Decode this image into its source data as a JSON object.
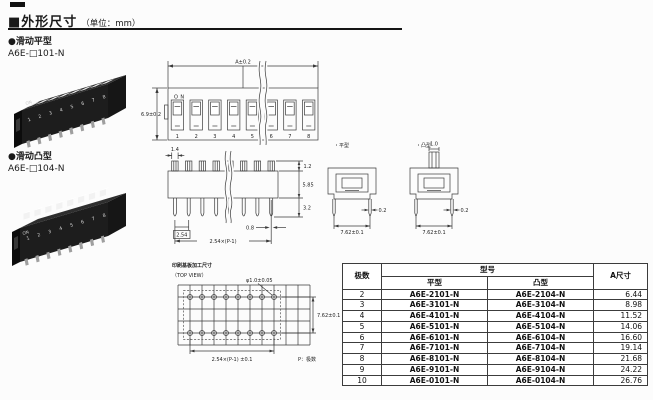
{
  "page": {
    "title": "■外形尺寸",
    "unit": "（单位：mm）"
  },
  "sections": {
    "flat": {
      "label": "●滑动平型",
      "model": "A6E-□101-N"
    },
    "convex": {
      "label": "●滑动凸型",
      "model": "A6E-□104-N"
    }
  },
  "switch_labels": {
    "on": "ON",
    "positions": [
      "1",
      "2",
      "3",
      "4",
      "5",
      "6",
      "7",
      "8"
    ]
  },
  "front_view": {
    "dim_width": "A±0.2",
    "dim_height": "6.9±0.2"
  },
  "side_elevation": {
    "dim_knob_width": "1.4",
    "dim_protrusion": "1.2",
    "dim_body_height": "5.85",
    "dim_pin_length": "3.2",
    "dim_pitch": "2.54",
    "dim_span": "2.54×(P-1)",
    "dim_pin_width": "0.8"
  },
  "side_views": {
    "flat_label": "・平型",
    "convex_label": "・凸型",
    "dim_knob_width": "1.0",
    "dim_pin_thickness": "0.2",
    "dim_row_pitch": "7.62±0.1"
  },
  "pcb": {
    "title": "印刷基板加工尺寸",
    "view_label": "（TOP VIEW）",
    "dim_hole": "φ1.0±0.05",
    "dim_row_pitch": "7.62±0.1",
    "dim_span": "2.54×(P-1) ±0.1",
    "note": "P：极数"
  },
  "table": {
    "header_poles": "极数",
    "header_model": "型号",
    "header_flat": "平型",
    "header_convex": "凸型",
    "header_dim": "A尺寸",
    "rows": [
      {
        "poles": "2",
        "flat": "A6E-2101-N",
        "convex": "A6E-2104-N",
        "a": "6.44"
      },
      {
        "poles": "3",
        "flat": "A6E-3101-N",
        "convex": "A6E-3104-N",
        "a": "8.98"
      },
      {
        "poles": "4",
        "flat": "A6E-4101-N",
        "convex": "A6E-4104-N",
        "a": "11.52"
      },
      {
        "poles": "5",
        "flat": "A6E-5101-N",
        "convex": "A6E-5104-N",
        "a": "14.06"
      },
      {
        "poles": "6",
        "flat": "A6E-6101-N",
        "convex": "A6E-6104-N",
        "a": "16.60"
      },
      {
        "poles": "7",
        "flat": "A6E-7101-N",
        "convex": "A6E-7104-N",
        "a": "19.14"
      },
      {
        "poles": "8",
        "flat": "A6E-8101-N",
        "convex": "A6E-8104-N",
        "a": "21.68"
      },
      {
        "poles": "9",
        "flat": "A6E-9101-N",
        "convex": "A6E-9104-N",
        "a": "24.22"
      },
      {
        "poles": "10",
        "flat": "A6E-0101-N",
        "convex": "A6E-0104-N",
        "a": "26.76"
      }
    ]
  }
}
